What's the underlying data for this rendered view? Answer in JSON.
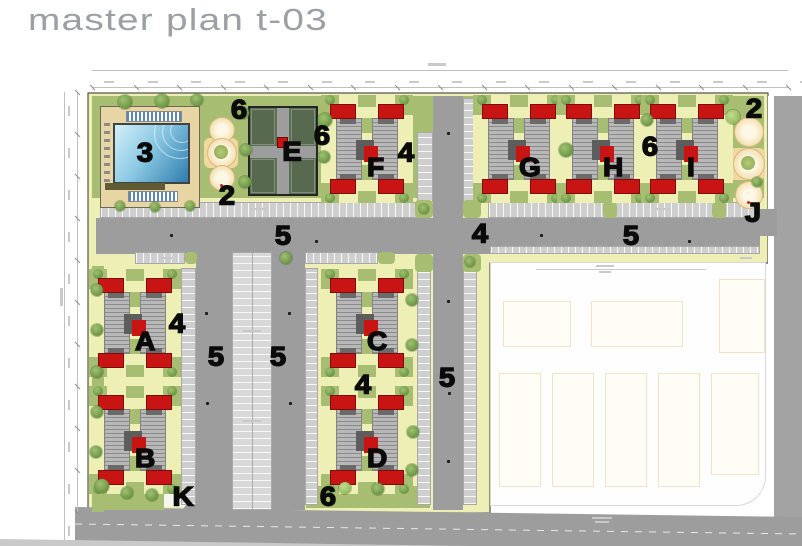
{
  "title": "master plan t-03",
  "plan": {
    "markers": [
      {
        "text": "6",
        "x": 239,
        "y": 110
      },
      {
        "text": "2",
        "x": 227,
        "y": 196
      },
      {
        "text": "E",
        "x": 292,
        "y": 152
      },
      {
        "text": "6",
        "x": 322,
        "y": 136
      },
      {
        "text": "4",
        "x": 406,
        "y": 153
      },
      {
        "text": "6",
        "x": 650,
        "y": 147
      },
      {
        "text": "2",
        "x": 754,
        "y": 109
      },
      {
        "text": "J",
        "x": 753,
        "y": 213
      },
      {
        "text": "5",
        "x": 283,
        "y": 236
      },
      {
        "text": "4",
        "x": 480,
        "y": 234
      },
      {
        "text": "5",
        "x": 631,
        "y": 236
      },
      {
        "text": "4",
        "x": 177,
        "y": 324
      },
      {
        "text": "5",
        "x": 216,
        "y": 357
      },
      {
        "text": "5",
        "x": 278,
        "y": 357
      },
      {
        "text": "4",
        "x": 363,
        "y": 385
      },
      {
        "text": "5",
        "x": 447,
        "y": 378
      },
      {
        "text": "K",
        "x": 183,
        "y": 497
      },
      {
        "text": "6",
        "x": 328,
        "y": 497
      },
      {
        "text": "3",
        "x": 145,
        "y": 153
      }
    ],
    "buildings": [
      {
        "letter": "A",
        "x": 98,
        "y": 276
      },
      {
        "letter": "B",
        "x": 98,
        "y": 393
      },
      {
        "letter": "C",
        "x": 330,
        "y": 276
      },
      {
        "letter": "D",
        "x": 330,
        "y": 393
      },
      {
        "letter": "F",
        "x": 330,
        "y": 102
      },
      {
        "letter": "G",
        "x": 482,
        "y": 102
      },
      {
        "letter": "H",
        "x": 566,
        "y": 102
      },
      {
        "letter": "I",
        "x": 650,
        "y": 102
      }
    ],
    "colors": {
      "path_yellow": "#edefb4",
      "lawn_green": "#a6bd72",
      "road_gray": "#9d9d9d",
      "roof_red": "#c91414",
      "pool_blue": "#2e7dad",
      "court_green": "#5d7055",
      "label_black": "#0a0a0a",
      "title_gray": "#9aa0a4"
    }
  }
}
